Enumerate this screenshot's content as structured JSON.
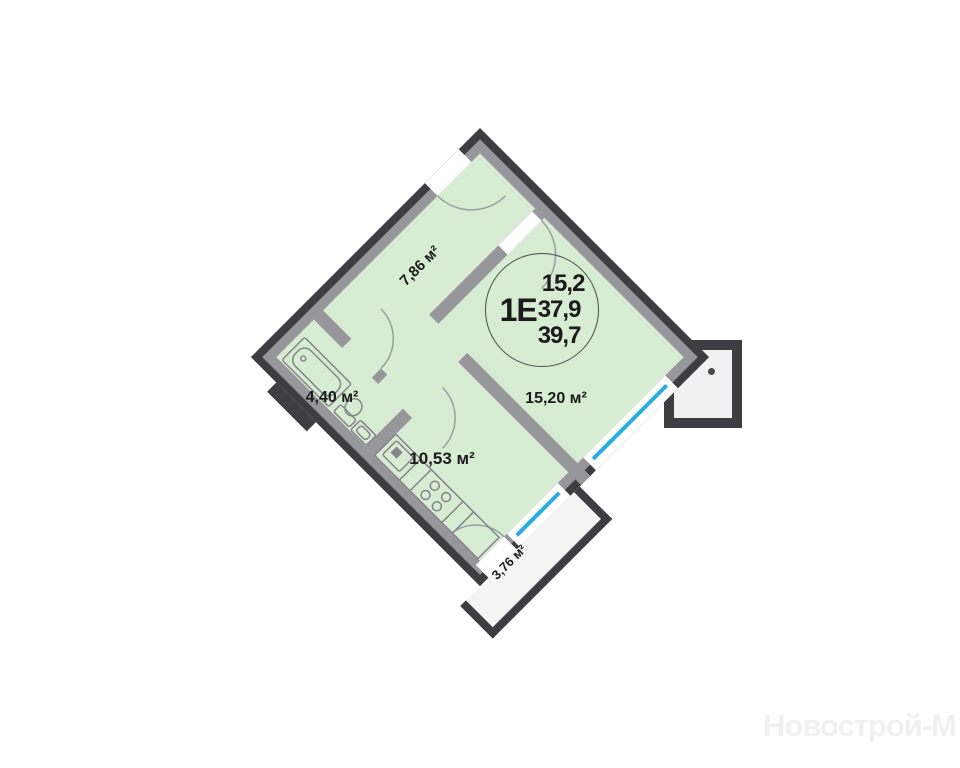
{
  "plan": {
    "unit_badge": {
      "unit_code": "1Е",
      "living_area": "15,2",
      "floor_area": "37,9",
      "total_area": "39,7"
    },
    "rooms": [
      {
        "name": "hallway",
        "area": "7,86 м²"
      },
      {
        "name": "bathroom",
        "area": "4,40 м²"
      },
      {
        "name": "kitchen",
        "area": "10,53 м²"
      },
      {
        "name": "living-room",
        "area": "15,20 м²"
      },
      {
        "name": "balcony",
        "area": "3,76 м²"
      }
    ],
    "colors": {
      "floor": "#d8ebd3",
      "wall_dark": "#3e3e42",
      "wall_light": "#97979b",
      "window": "#2aabe2",
      "balcony_fill": "#f4f4f4"
    }
  },
  "watermark": {
    "text": "Новострой-М"
  }
}
